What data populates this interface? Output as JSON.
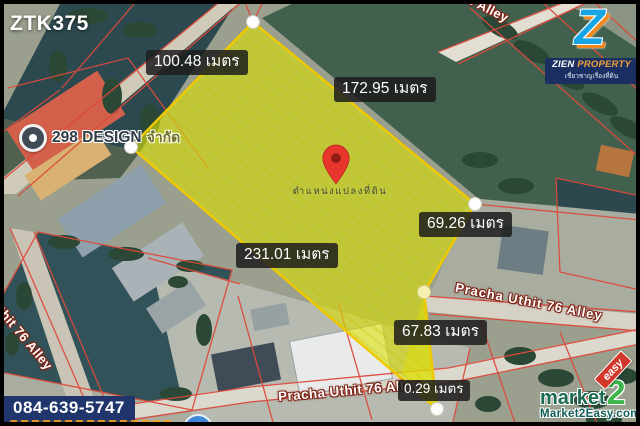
{
  "badge": {
    "code": "ZTK375"
  },
  "logo": {
    "zien": "ZIEN",
    "property": "PROPERTY",
    "tagline": "เชี่ยวชาญเรื่องที่ดิน"
  },
  "place": {
    "name": "298 DESIGN",
    "suffix": "จำกัด"
  },
  "pin": {
    "label": "ตำแหน่งแปลงที่ดิน",
    "color": "#e8362d"
  },
  "measurements": [
    {
      "side": "upper-left-edge",
      "text": "100.48 เมตร"
    },
    {
      "side": "upper-right-edge",
      "text": "172.95 เมตร"
    },
    {
      "side": "right-edge",
      "text": "69.26 เมตร"
    },
    {
      "side": "long-left-edge",
      "text": "231.01 เมตร"
    },
    {
      "side": "lower-right-edge",
      "text": "67.83 เมตร"
    },
    {
      "side": "bottom-tip-edge",
      "text": "0.29 เมตร"
    }
  ],
  "roads": {
    "alley": "Pracha Uthit 76 Alley",
    "alley_partial": "6 Alley"
  },
  "contact": {
    "phone": "084-639-5747"
  },
  "watermark": {
    "market": "market",
    "two": "2",
    "easy": "easy",
    "site": "Market2Easy.com"
  },
  "colors": {
    "plot_fill": "#dce104",
    "plot_stroke": "#eec800",
    "parcel_lines": "#dc4a3c",
    "phone_bg": "#20356b",
    "logo_navy": "#1c2f63",
    "logo_blue": "#17a5e6",
    "logo_orange": "#f08a1f",
    "watermark_green": "#3cb54b",
    "watermark_red": "#d3382c"
  }
}
